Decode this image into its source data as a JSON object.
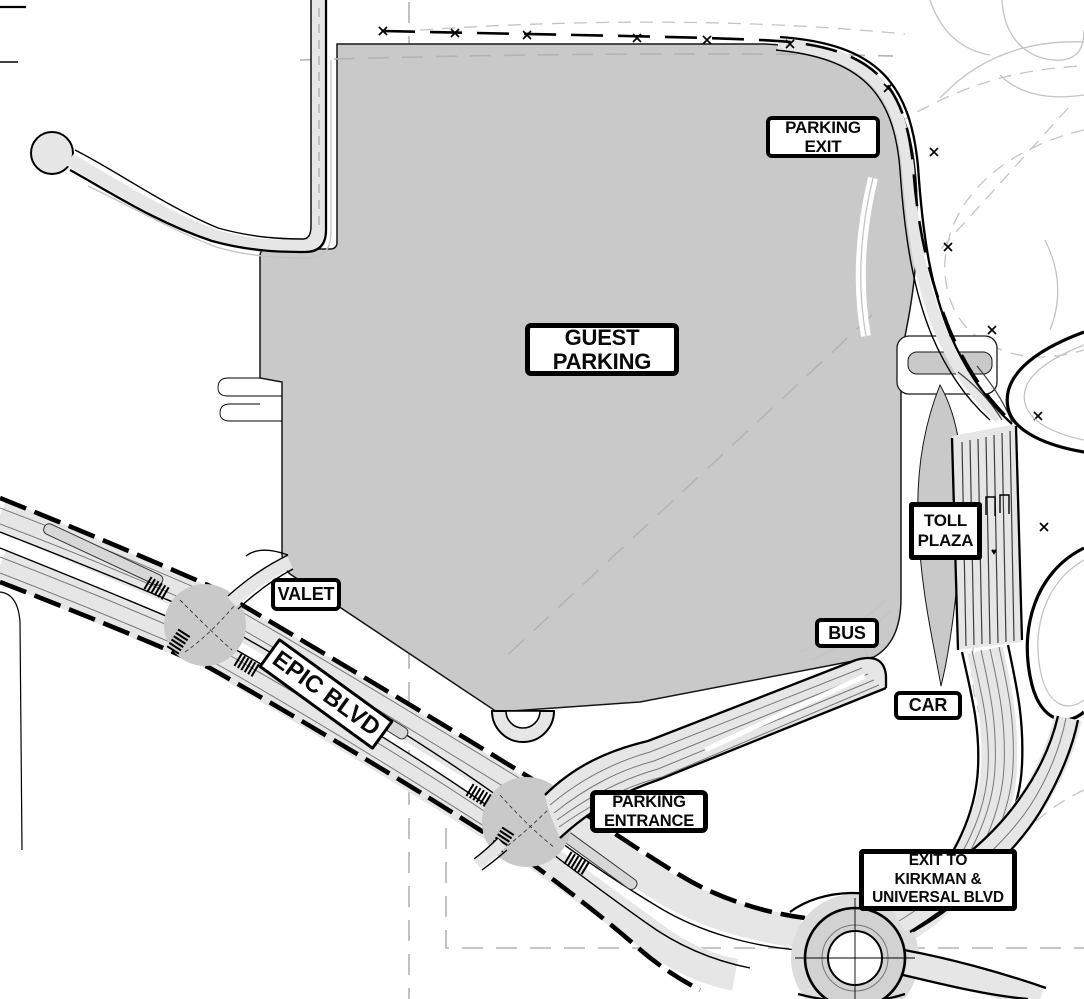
{
  "map_labels": {
    "guest_parking": "GUEST\nPARKING",
    "parking_exit": "PARKING\nEXIT",
    "toll_plaza": "TOLL\nPLAZA",
    "valet": "VALET",
    "bus": "BUS",
    "car": "CAR",
    "parking_entrance": "PARKING\nENTRANCE",
    "exit_to_kirkman": "EXIT TO\nKIRKMAN &\nUNIVERSAL BLVD",
    "epic_blvd": "EPIC BLVD"
  },
  "map_symbols": {
    "heart_marker": "♥"
  },
  "colors": {
    "background": "#ffffff",
    "parking_lot_fill": "#c9c9c9",
    "road_fill": "#e6e6e6",
    "line": "#000000",
    "faint_line": "#c4c4c4",
    "lane_line": "#777777",
    "property_dash": "#b3b3b3"
  }
}
